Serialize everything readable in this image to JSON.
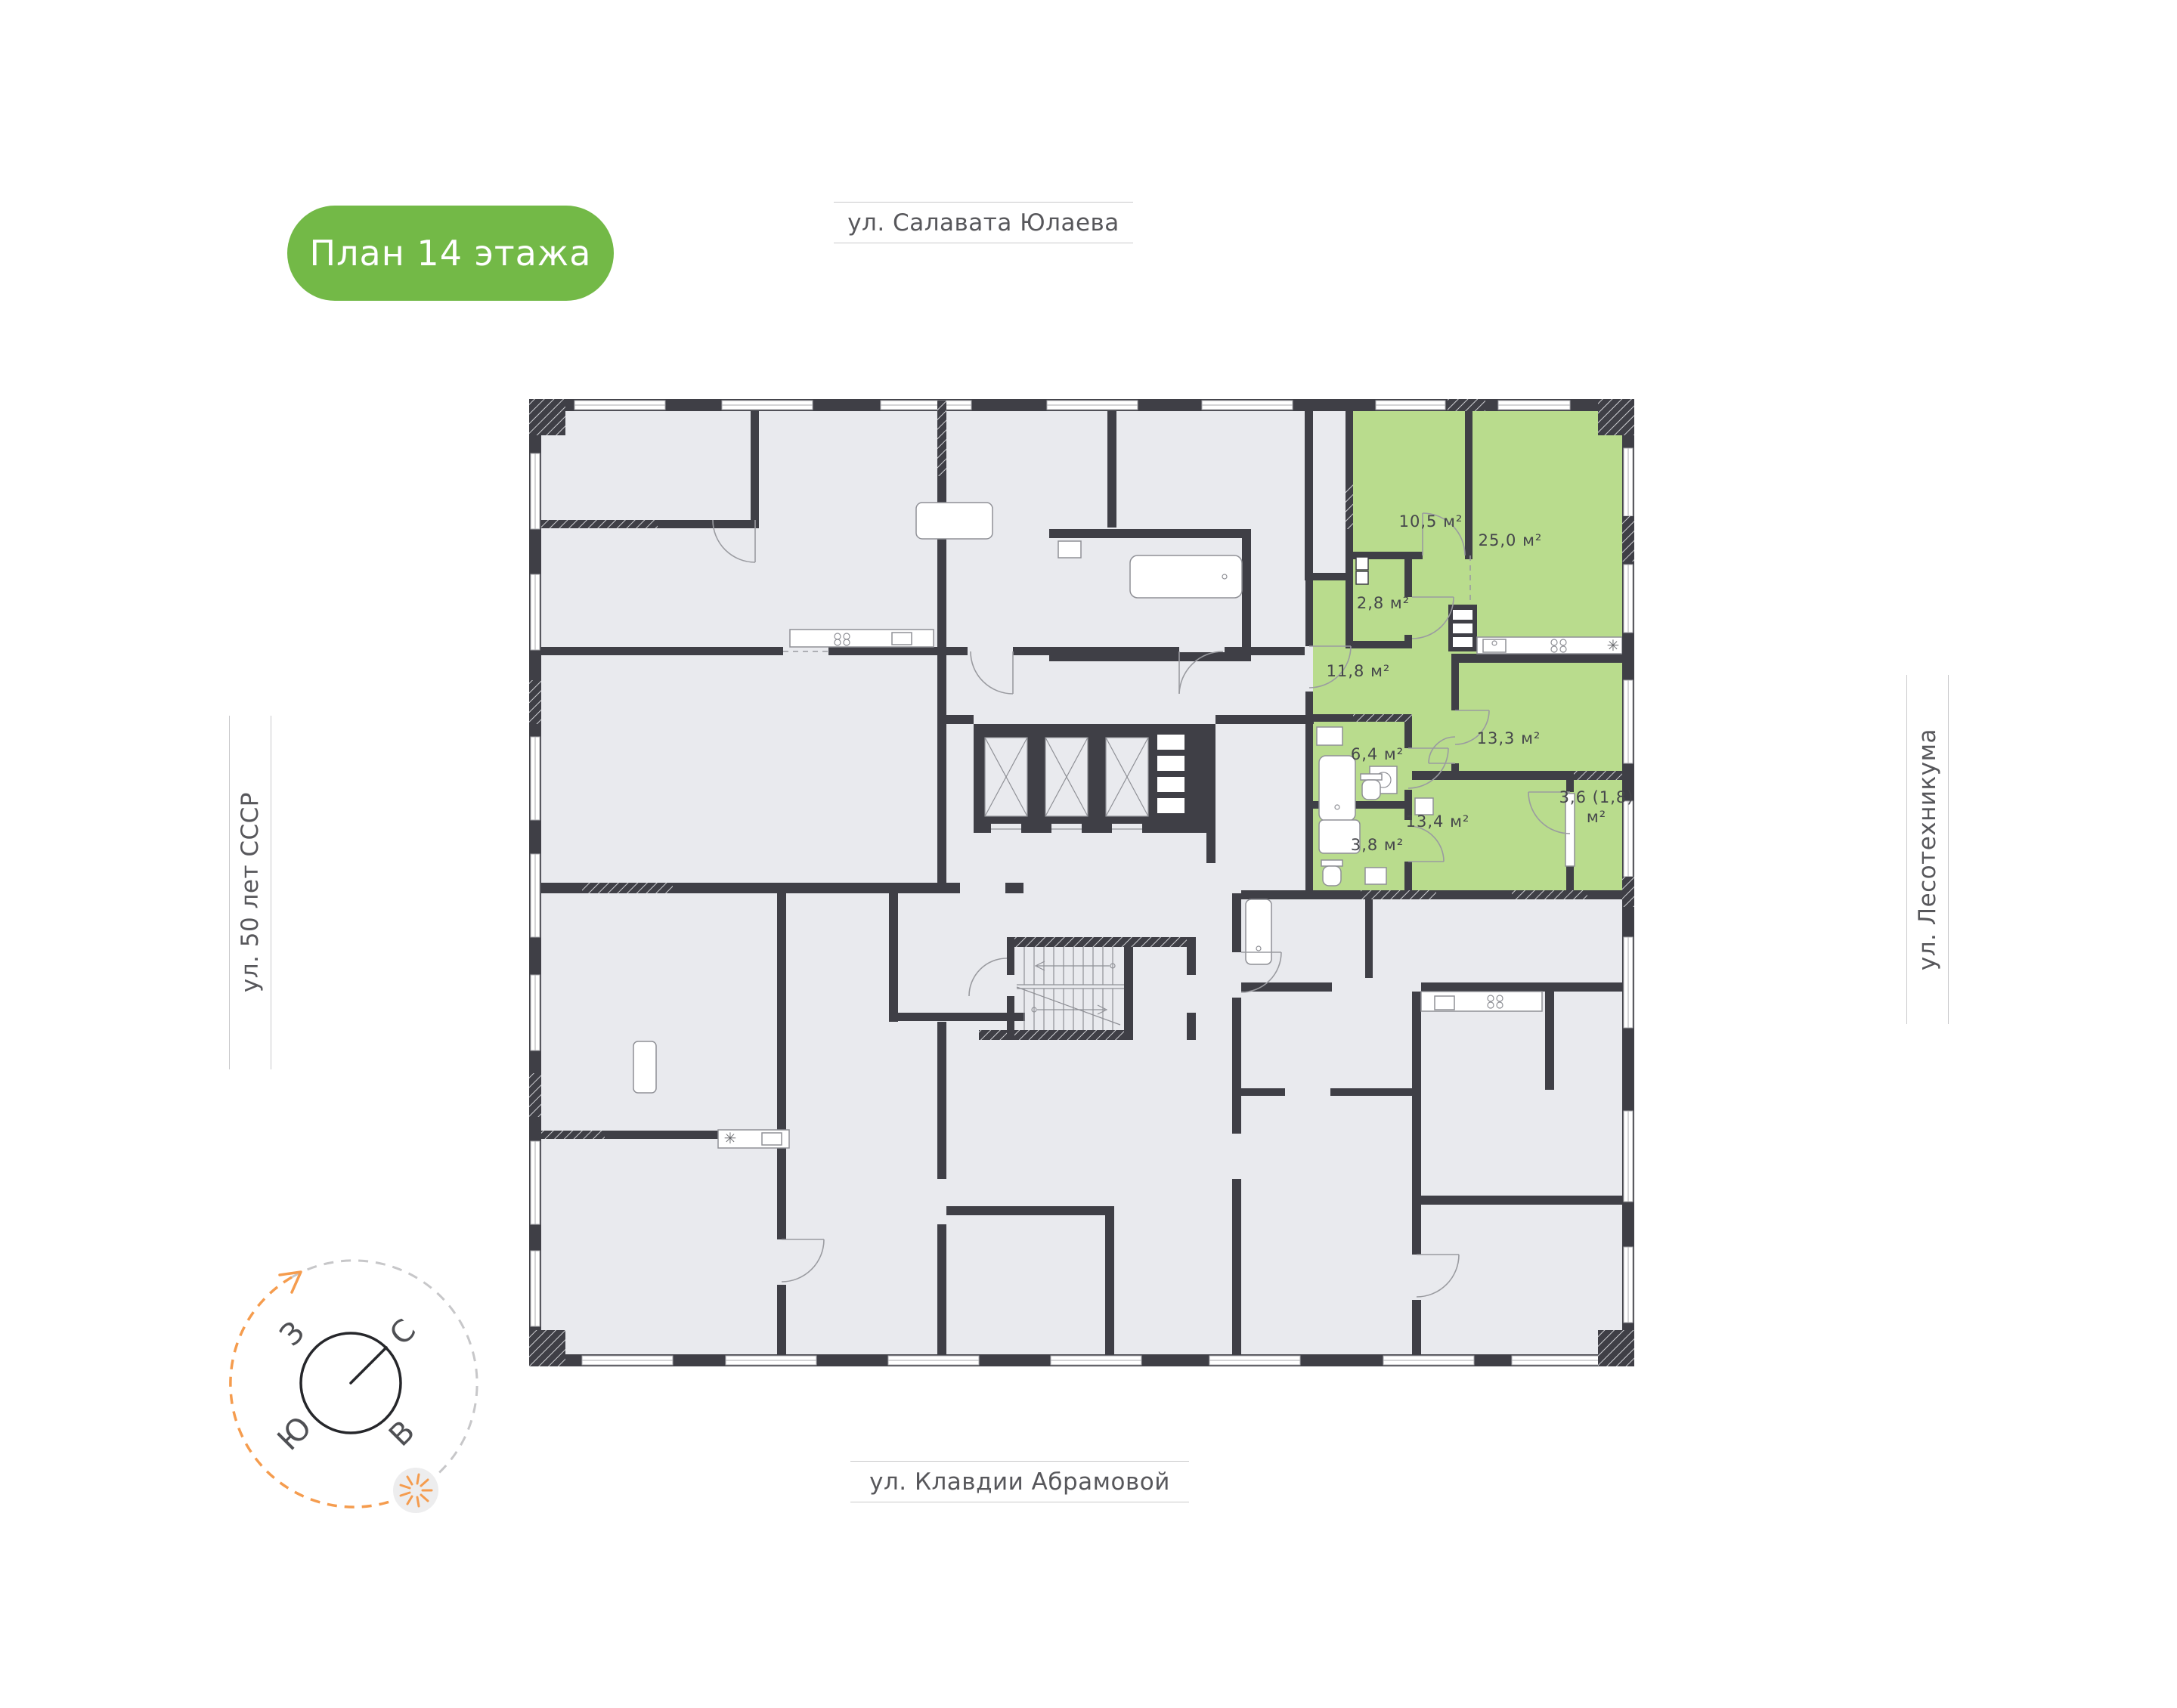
{
  "badge": {
    "label": "План 14 этажа"
  },
  "streets": {
    "top": "ул. Салавата Юлаева",
    "bottom": "ул. Клавдии Абрамовой",
    "left": "ул. 50 лет СССР",
    "right": "ул. Лесотехникума"
  },
  "compass": {
    "west": "З",
    "north": "С",
    "south": "Ю",
    "east": "В"
  },
  "plan": {
    "rooms": [
      {
        "label": "10,5 м²"
      },
      {
        "label": "25,0 м²"
      },
      {
        "label": "2,8 м²"
      },
      {
        "label": "11,8 м²"
      },
      {
        "label": "13,3 м²"
      },
      {
        "label": "6,4 м²"
      },
      {
        "label": "13,4 м²"
      },
      {
        "label": "3,8 м²"
      },
      {
        "label": "3,6 (1,8)",
        "label2": "м²"
      }
    ],
    "icons": {
      "fridge": "✳"
    },
    "colors": {
      "highlight": "#b9dc8d",
      "wall": "#3f3f46",
      "floor": "#e9eaee",
      "accent_orange": "#f59c4e",
      "badge_green": "#73b947"
    }
  }
}
